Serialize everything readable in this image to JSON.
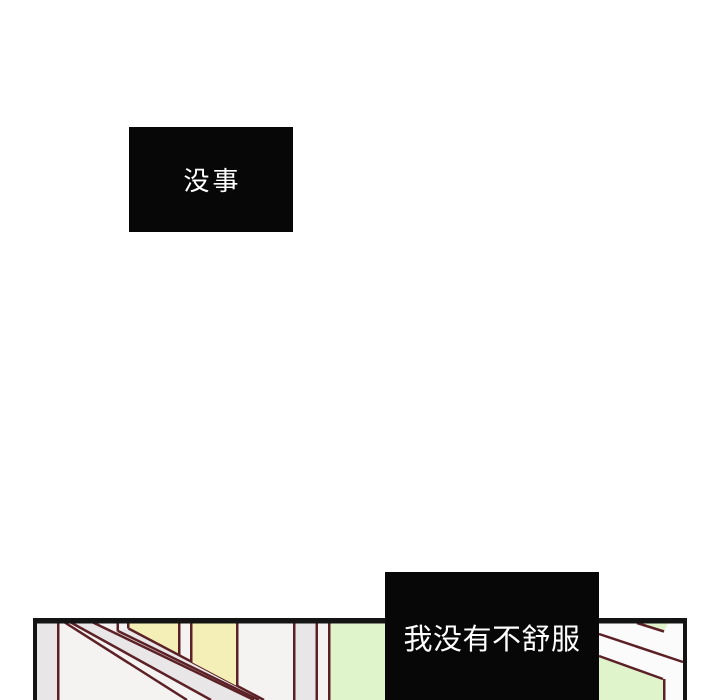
{
  "page": {
    "kind": "comic-panel-page",
    "background": "#ffffff"
  },
  "speech_boxes": {
    "top": {
      "text": "没事"
    },
    "bottom": {
      "text": "我没有不舒服"
    }
  },
  "panel": {
    "description": "bottom partial panel: slanted ceiling beams with yellow window panes and pale green wall",
    "colors": {
      "border": "#141414",
      "beam_line": "#5c2126",
      "window_yellow": "#f4efb6",
      "wall_green": "#e0f4cc",
      "shade_gray": "#e9e6e7",
      "wall_offwhite": "#f5f2f2",
      "white_band": "#fcfbfb",
      "box_bg": "#070707",
      "box_text": "#ffffff"
    }
  }
}
